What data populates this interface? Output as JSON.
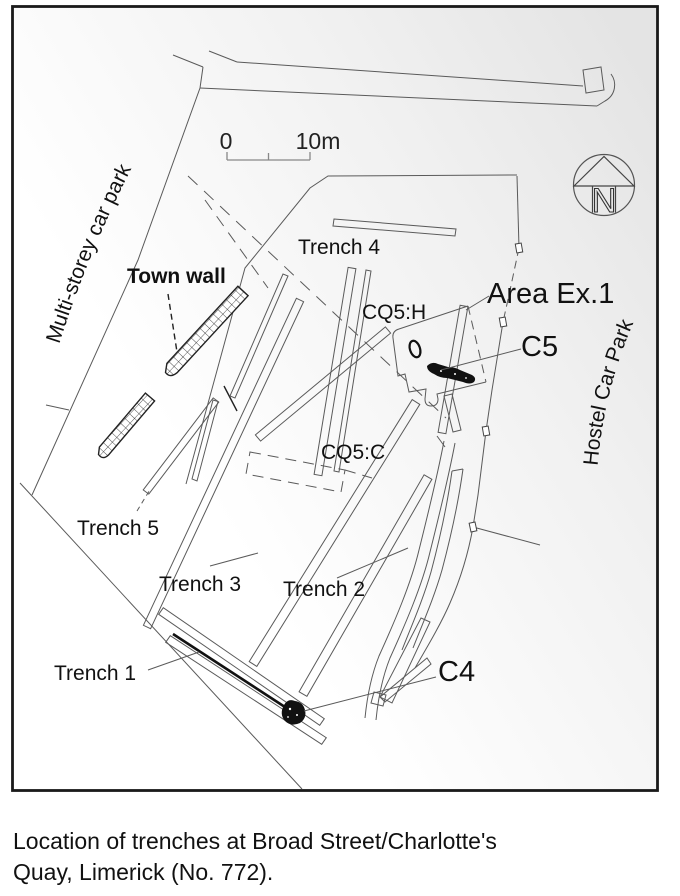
{
  "caption": {
    "line1": "Location of trenches at Broad Street/Charlotte's",
    "line2": "Quay, Limerick (No. 772)."
  },
  "map": {
    "area_labels": {
      "multi_storey_car_park": "Multi-storey car park",
      "hostel_car_park": "Hostel Car Park"
    },
    "feature_labels": {
      "town_wall": "Town wall",
      "trench_1": "Trench 1",
      "trench_2": "Trench 2",
      "trench_3": "Trench 3",
      "trench_4": "Trench 4",
      "trench_5": "Trench 5",
      "cq5_h": "CQ5:H",
      "cq5_c": "CQ5:C",
      "area_ex_1": "Area Ex.1",
      "c5": "C5",
      "c4": "C4"
    },
    "scale_bar": {
      "start_label": "0",
      "end_label": "10m"
    },
    "north_arrow_letter": "N",
    "colors": {
      "linework": "#5a5a5a",
      "dark_features": "#111111",
      "frame": "#1a1a1a",
      "background_tint": "#e4e4e4"
    }
  }
}
